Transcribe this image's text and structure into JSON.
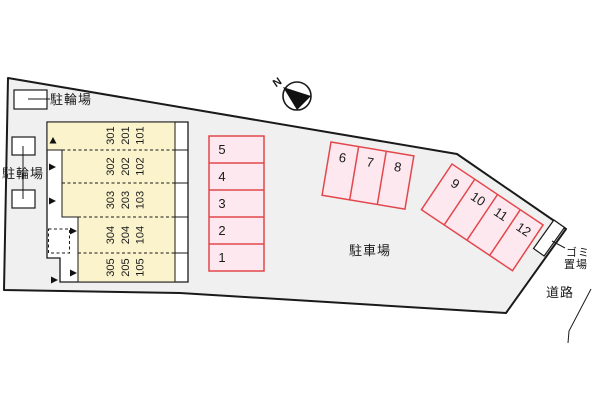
{
  "labels": {
    "parking_area": "駐車場",
    "road": "道路",
    "garbage_line1": "ゴミ",
    "garbage_line2": "置場",
    "bicycle_top": "駐輪場",
    "bicycle_left": "駐輪場",
    "compass_north": "N"
  },
  "building": {
    "rows": [
      [
        "301",
        "201",
        "101"
      ],
      [
        "302",
        "202",
        "102"
      ],
      [
        "303",
        "203",
        "103"
      ],
      [
        "304",
        "204",
        "104"
      ],
      [
        "305",
        "205",
        "105"
      ]
    ]
  },
  "parking_spaces": {
    "column": [
      "5",
      "4",
      "3",
      "2",
      "1"
    ],
    "top_row": [
      "6",
      "7",
      "8"
    ],
    "diagonal_row": [
      "9",
      "10",
      "11",
      "12"
    ]
  },
  "colors": {
    "site_fill": "#f0f0f0",
    "outline": "#1a1a1a",
    "building_fill": "#faf3cb",
    "space_fill": "#fde8f0",
    "space_border": "#e2474b"
  }
}
